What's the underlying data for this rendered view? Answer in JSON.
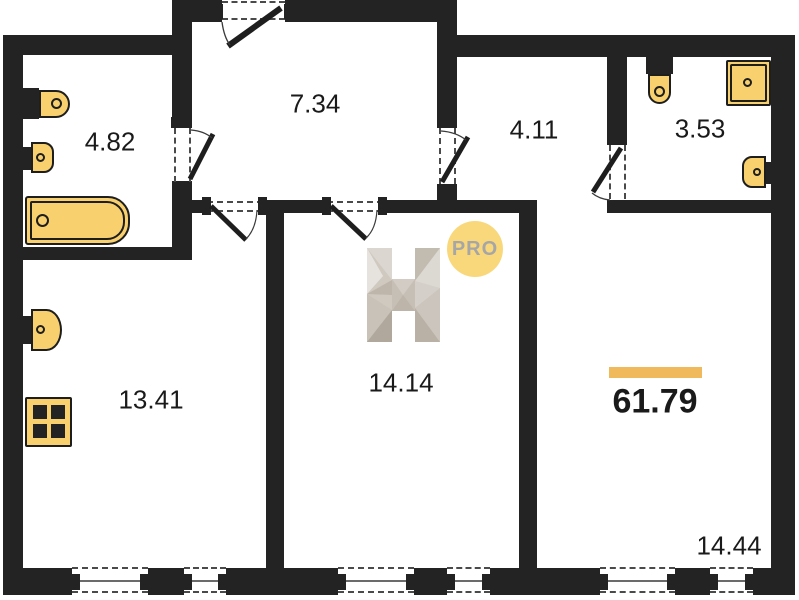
{
  "plan": {
    "logo": {
      "letter": "H",
      "badge": "PRO"
    },
    "total_area": "61.79",
    "rooms": [
      {
        "name": "bathroom-top-left",
        "area": "4.82"
      },
      {
        "name": "hallway",
        "area": "7.34"
      },
      {
        "name": "corridor",
        "area": "4.11"
      },
      {
        "name": "bathroom-top-right",
        "area": "3.53"
      },
      {
        "name": "kitchen-living",
        "area": "13.41"
      },
      {
        "name": "room-middle",
        "area": "14.14"
      },
      {
        "name": "bedroom-right",
        "area": "14.44"
      }
    ],
    "fixtures": [
      "toilet",
      "wash-sink",
      "bathtub",
      "kitchen-sink",
      "stove",
      "toilet",
      "shower-cabin",
      "wash-sink"
    ],
    "colors": {
      "wall": "#232323",
      "fixture_fill": "#f8d06e",
      "accent_bar": "#efb95c",
      "badge_bg": "#f9d87c",
      "badge_text": "#a6a6a6"
    }
  }
}
